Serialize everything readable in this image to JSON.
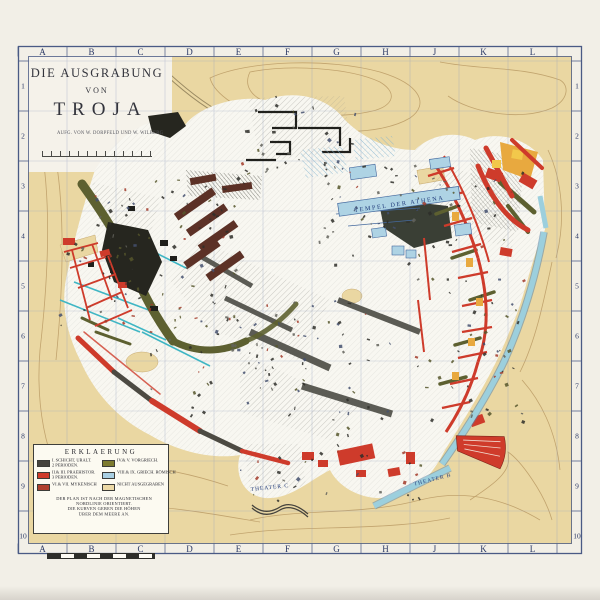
{
  "map": {
    "title": {
      "line1": "DIE AUSGRABUNG",
      "line2": "VON",
      "line3": "TROJA",
      "credit": "AUFG. VON W. DÖRPFELD UND W. WILBERG"
    },
    "grid": {
      "columns": [
        "A",
        "B",
        "C",
        "D",
        "E",
        "F",
        "G",
        "H",
        "J",
        "K",
        "L"
      ],
      "rows": [
        "1",
        "2",
        "3",
        "4",
        "5",
        "6",
        "7",
        "8",
        "9",
        "10"
      ]
    },
    "labels": {
      "temple": "TEMPEL DER ATHENA",
      "theater_c": "THEATER C",
      "theater_b": "THEATER B"
    },
    "legend": {
      "title": "ERKLAERUNG",
      "entries": [
        {
          "swatch": "#45433d",
          "label": "I. SCHICHT, URALT.",
          "sub": "2 PERIODEN."
        },
        {
          "swatch": "#cf3b2b",
          "label": "II.& III. PRAEHISTOR.",
          "sub": "3 PERIODEN."
        },
        {
          "swatch": "#b0402f",
          "label": "VI.& VII. MYKENISCH",
          "sub": ""
        },
        {
          "swatch": "#7d7b2f",
          "label": "IV.& V. VORGRIECH.",
          "sub": ""
        },
        {
          "swatch": "#a9cfe2",
          "label": "VIII.& IX. GRIECH. RÖMISCH",
          "sub": ""
        },
        {
          "swatch": "#ecd9a6",
          "label": "NICHT AUSGEGRABEN",
          "sub": ""
        }
      ],
      "notes": [
        "DER PLAN IST NACH DER MAGNETISCHEN",
        "NORDLINIE ORIENTIERT.",
        "DIE KURVEN GEBEN DIE HÖHEN",
        "ÜBER DEM MEERE AN."
      ]
    },
    "colors": {
      "paper": "#f2efe7",
      "terrain": "#ead7a2",
      "excavated": "#f8f7f1",
      "red_walls": "#ce3b2b",
      "olive_walls": "#5d6030",
      "maroon_megara": "#5c3126",
      "blue_classical": "#aed3e4",
      "city_wall_blue": "#9ccfdd",
      "orange_rooms": "#e8a93f",
      "frame_blue": "#4a5a85"
    }
  }
}
